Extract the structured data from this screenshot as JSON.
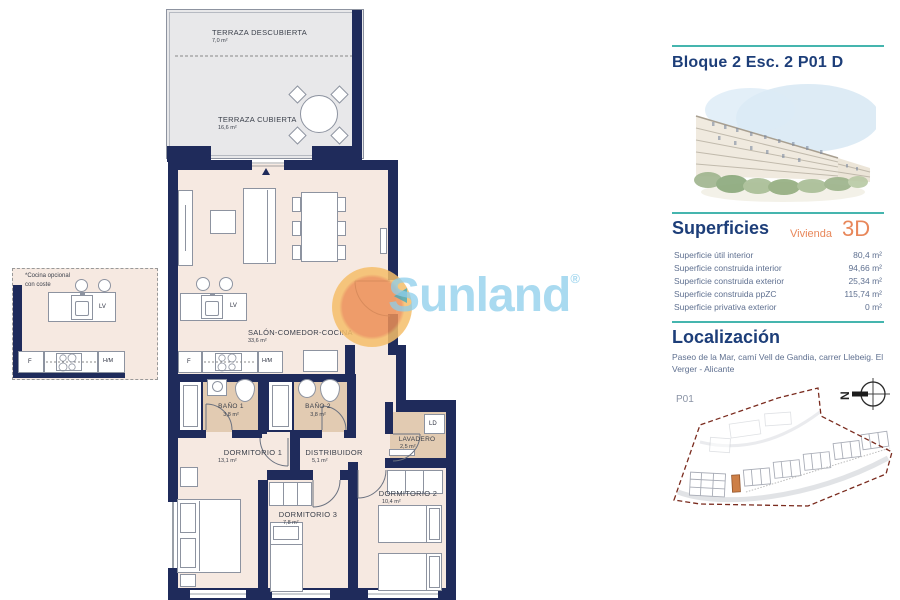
{
  "floorplan": {
    "terraza_descubierta": {
      "name": "TERRAZA DESCUBIERTA",
      "area": "7,0 m²"
    },
    "terraza_cubierta": {
      "name": "TERRAZA CUBIERTA",
      "area": "16,6 m²"
    },
    "salon": {
      "name": "SALÓN-COMEDOR-COCINA",
      "area": "33,6 m²"
    },
    "bano1": {
      "name": "BAÑO 1",
      "area": "3,8 m²"
    },
    "bano2": {
      "name": "BAÑO 2",
      "area": "3,8 m²"
    },
    "dormitorio1": {
      "name": "DORMITORIO 1",
      "area": "13,1 m²"
    },
    "dormitorio2": {
      "name": "DORMITORIO 2",
      "area": "10,4 m²"
    },
    "dormitorio3": {
      "name": "DORMITORIO 3",
      "area": "7,8 m²"
    },
    "distribuidor": {
      "name": "DISTRIBUIDOR",
      "area": "5,1 m²"
    },
    "lavadero": {
      "name": "LAVADERO",
      "area": "2,5 m²"
    },
    "labels": {
      "lv": "LV",
      "f": "F",
      "hm": "H/M",
      "ld": "LD"
    },
    "optional_kitchen_note": "*Cocina opcional\ncon coste"
  },
  "watermark": {
    "brand": "Sunland",
    "registered": "®"
  },
  "panel": {
    "title": "Bloque 2 Esc. 2 P01 D",
    "superficies_heading": "Superficies",
    "vivienda_label": "Vivienda",
    "unit_type": "3D",
    "superficies_rows": [
      {
        "label": "Superficie útil interior",
        "value": "80,4 m²"
      },
      {
        "label": "Superficie construida interior",
        "value": "94,66 m²"
      },
      {
        "label": "Superficie construida exterior",
        "value": "25,34 m²"
      },
      {
        "label": "Superficie construida ppZC",
        "value": "115,74 m²"
      },
      {
        "label": "Superficie privativa exterior",
        "value": "0 m²"
      }
    ],
    "localizacion_heading": "Localización",
    "address": "Paseo de la Mar, camí Vell de Gandia, carrer Llebeig. El Verger - Alicante",
    "siteplan_floor_label": "P01",
    "compass_letter": "N"
  },
  "colors": {
    "wall_navy": "#1f2b5b",
    "floor_pink": "#f6e9e1",
    "wet_room_tan": "#e2cbb2",
    "terrace_gray": "#e8e8ea",
    "accent_teal": "#45b5ae",
    "heading_blue": "#1d3e79",
    "accent_orange": "#e8875a",
    "site_boundary_red": "#7a2b1e",
    "highlight_unit_orange": "#cd7f47",
    "watermark_blue": "#8ccdeb",
    "watermark_sun_orange": "#ec8f55"
  }
}
